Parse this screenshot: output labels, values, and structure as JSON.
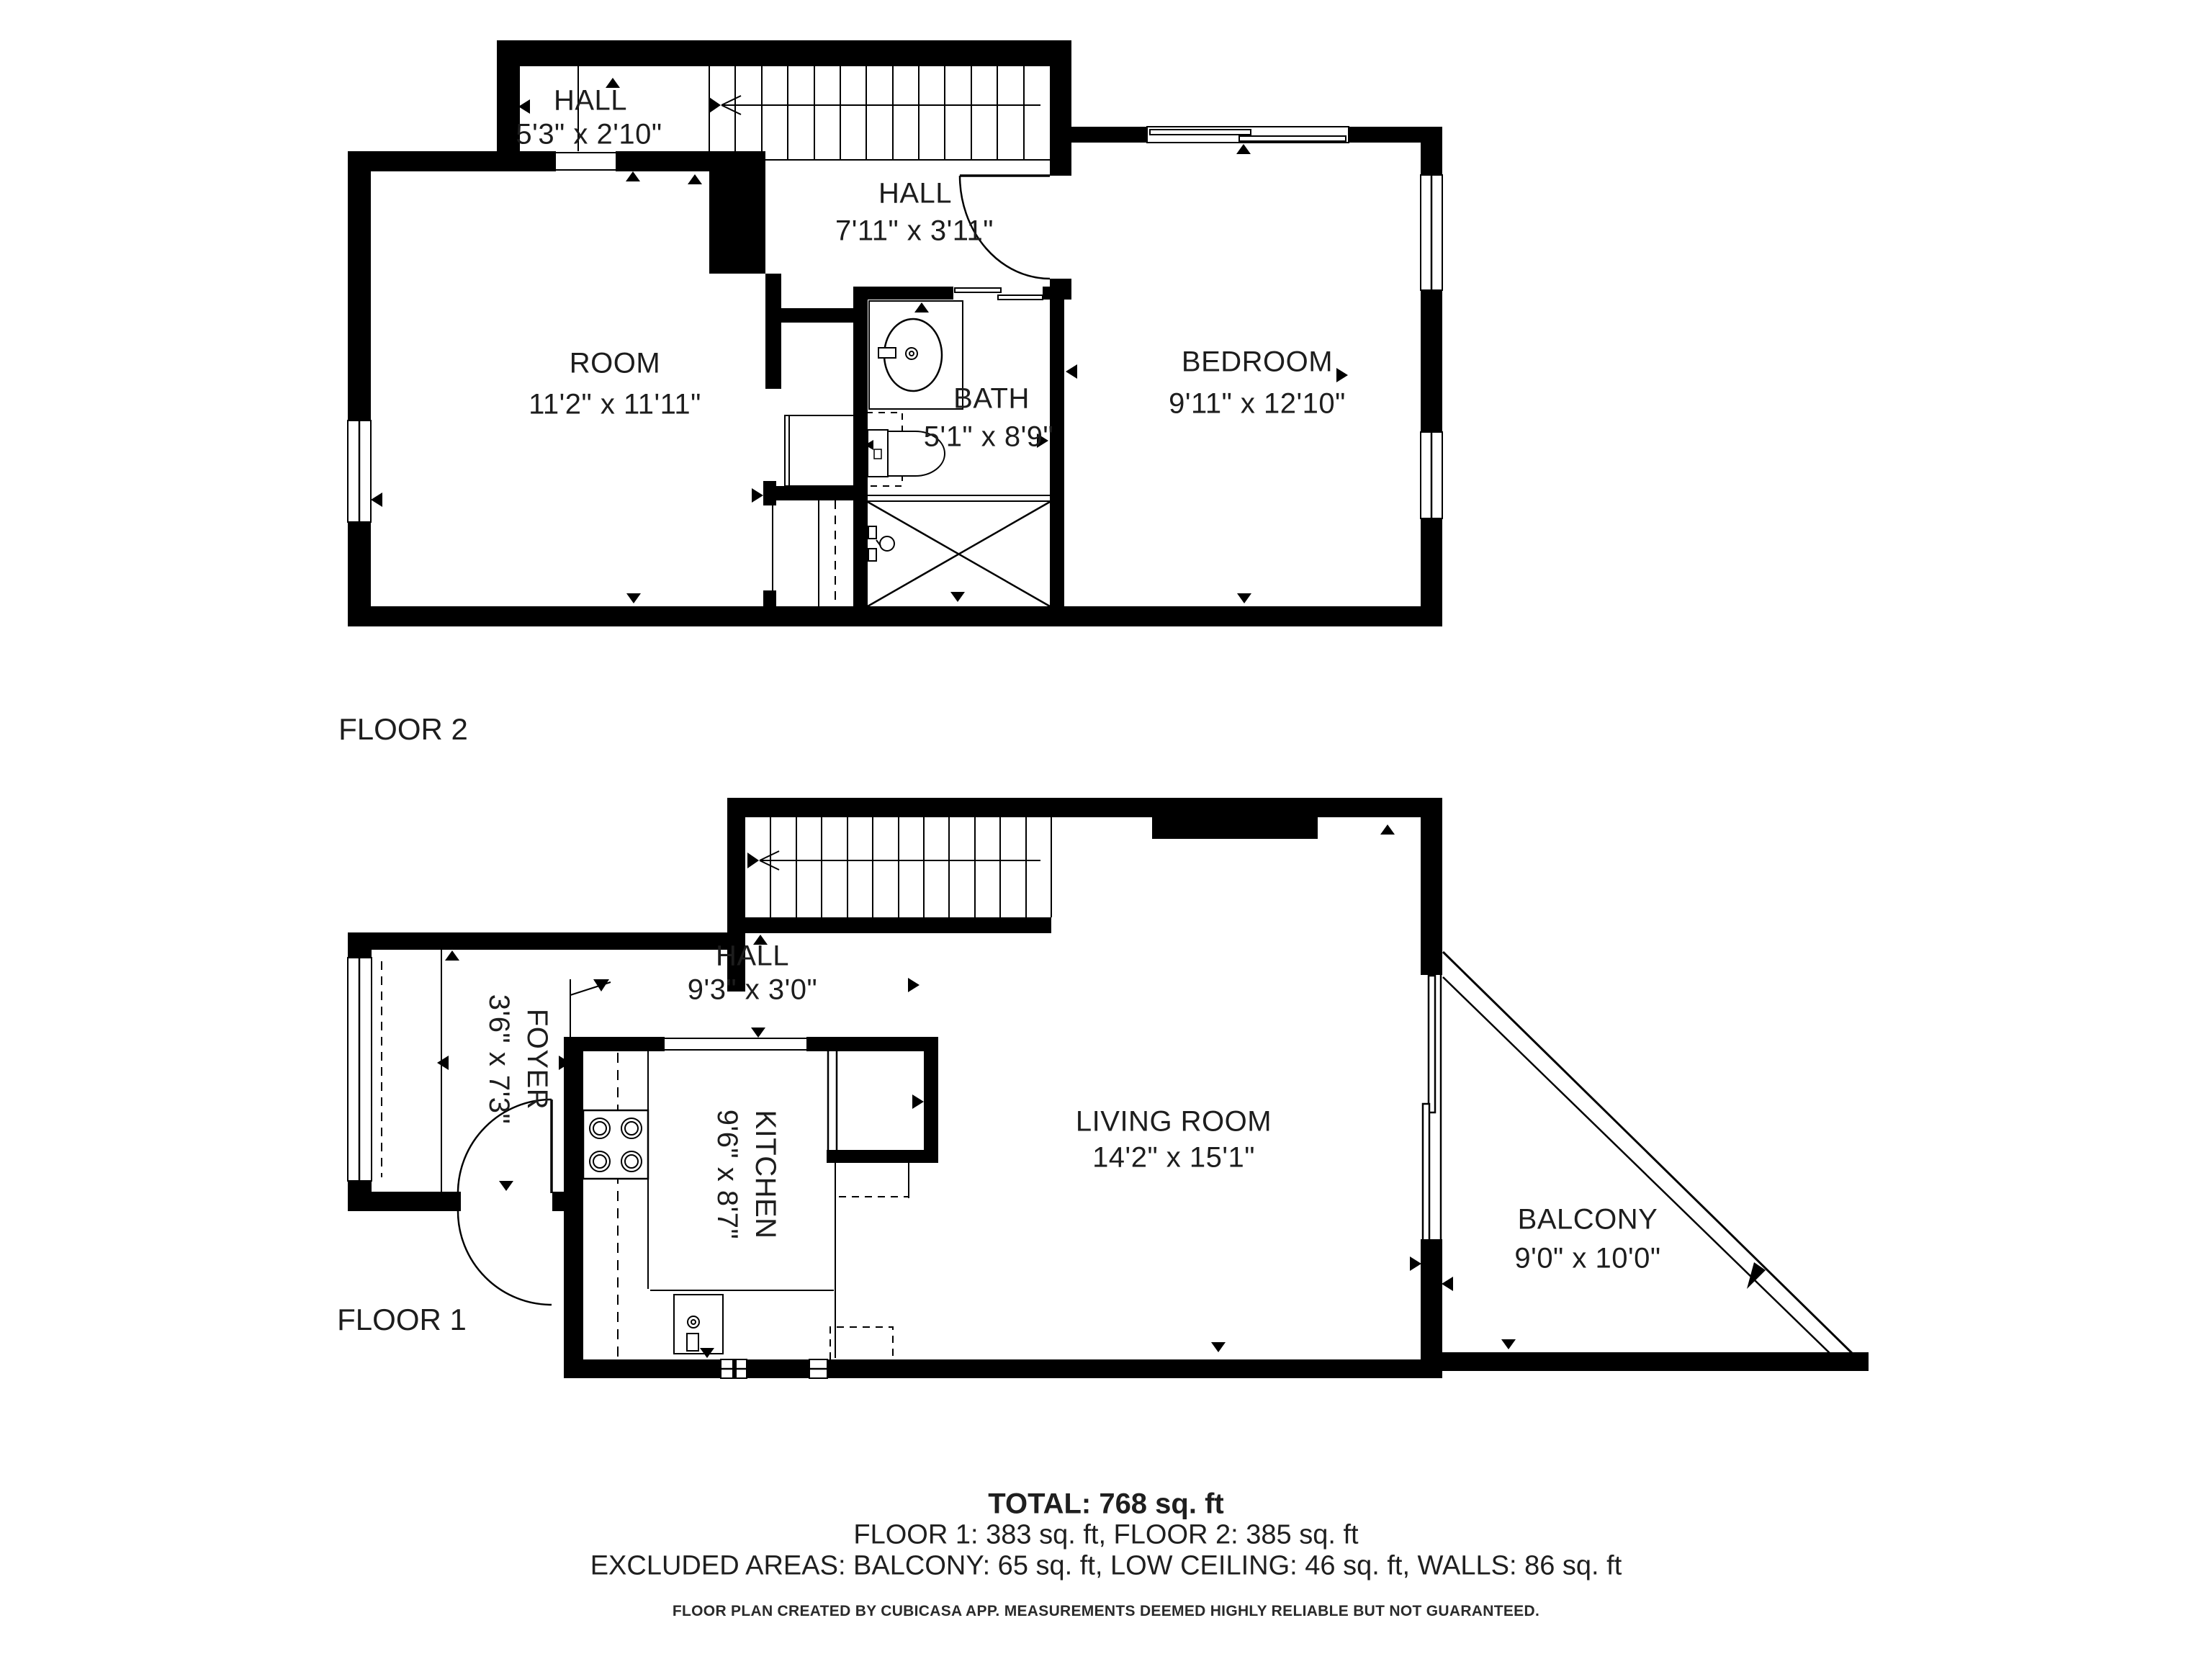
{
  "floor2": {
    "label": "FLOOR 2",
    "rooms": {
      "hall_upper": {
        "name": "HALL",
        "dims": "5'3\" x 2'10\""
      },
      "hall": {
        "name": "HALL",
        "dims": "7'11\" x 3'11\""
      },
      "room": {
        "name": "ROOM",
        "dims": "11'2\" x 11'11\""
      },
      "bath": {
        "name": "BATH",
        "dims": "5'1\" x 8'9\""
      },
      "bedroom": {
        "name": "BEDROOM",
        "dims": "9'11\" x 12'10\""
      }
    }
  },
  "floor1": {
    "label": "FLOOR 1",
    "rooms": {
      "hall": {
        "name": "HALL",
        "dims": "9'3\" x 3'0\""
      },
      "foyer": {
        "name": "FOYER",
        "dims": "3'6\" x 7'3\""
      },
      "kitchen": {
        "name": "KITCHEN",
        "dims": "9'6\" x 8'7\""
      },
      "living_room": {
        "name": "LIVING ROOM",
        "dims": "14'2\" x 15'1\""
      },
      "balcony": {
        "name": "BALCONY",
        "dims": "9'0\" x 10'0\""
      }
    }
  },
  "summary": {
    "total": "TOTAL: 768 sq. ft",
    "floors": "FLOOR 1: 383 sq. ft, FLOOR 2: 385 sq. ft",
    "excluded": "EXCLUDED AREAS: BALCONY: 65 sq. ft, LOW CEILING: 46 sq. ft, WALLS: 86 sq. ft",
    "disclaimer": "FLOOR PLAN CREATED BY CUBICASA APP. MEASUREMENTS DEEMED HIGHLY RELIABLE BUT NOT GUARANTEED."
  },
  "colors": {
    "wall": "#000000",
    "text": "#1d1d1d",
    "background": "#ffffff"
  }
}
